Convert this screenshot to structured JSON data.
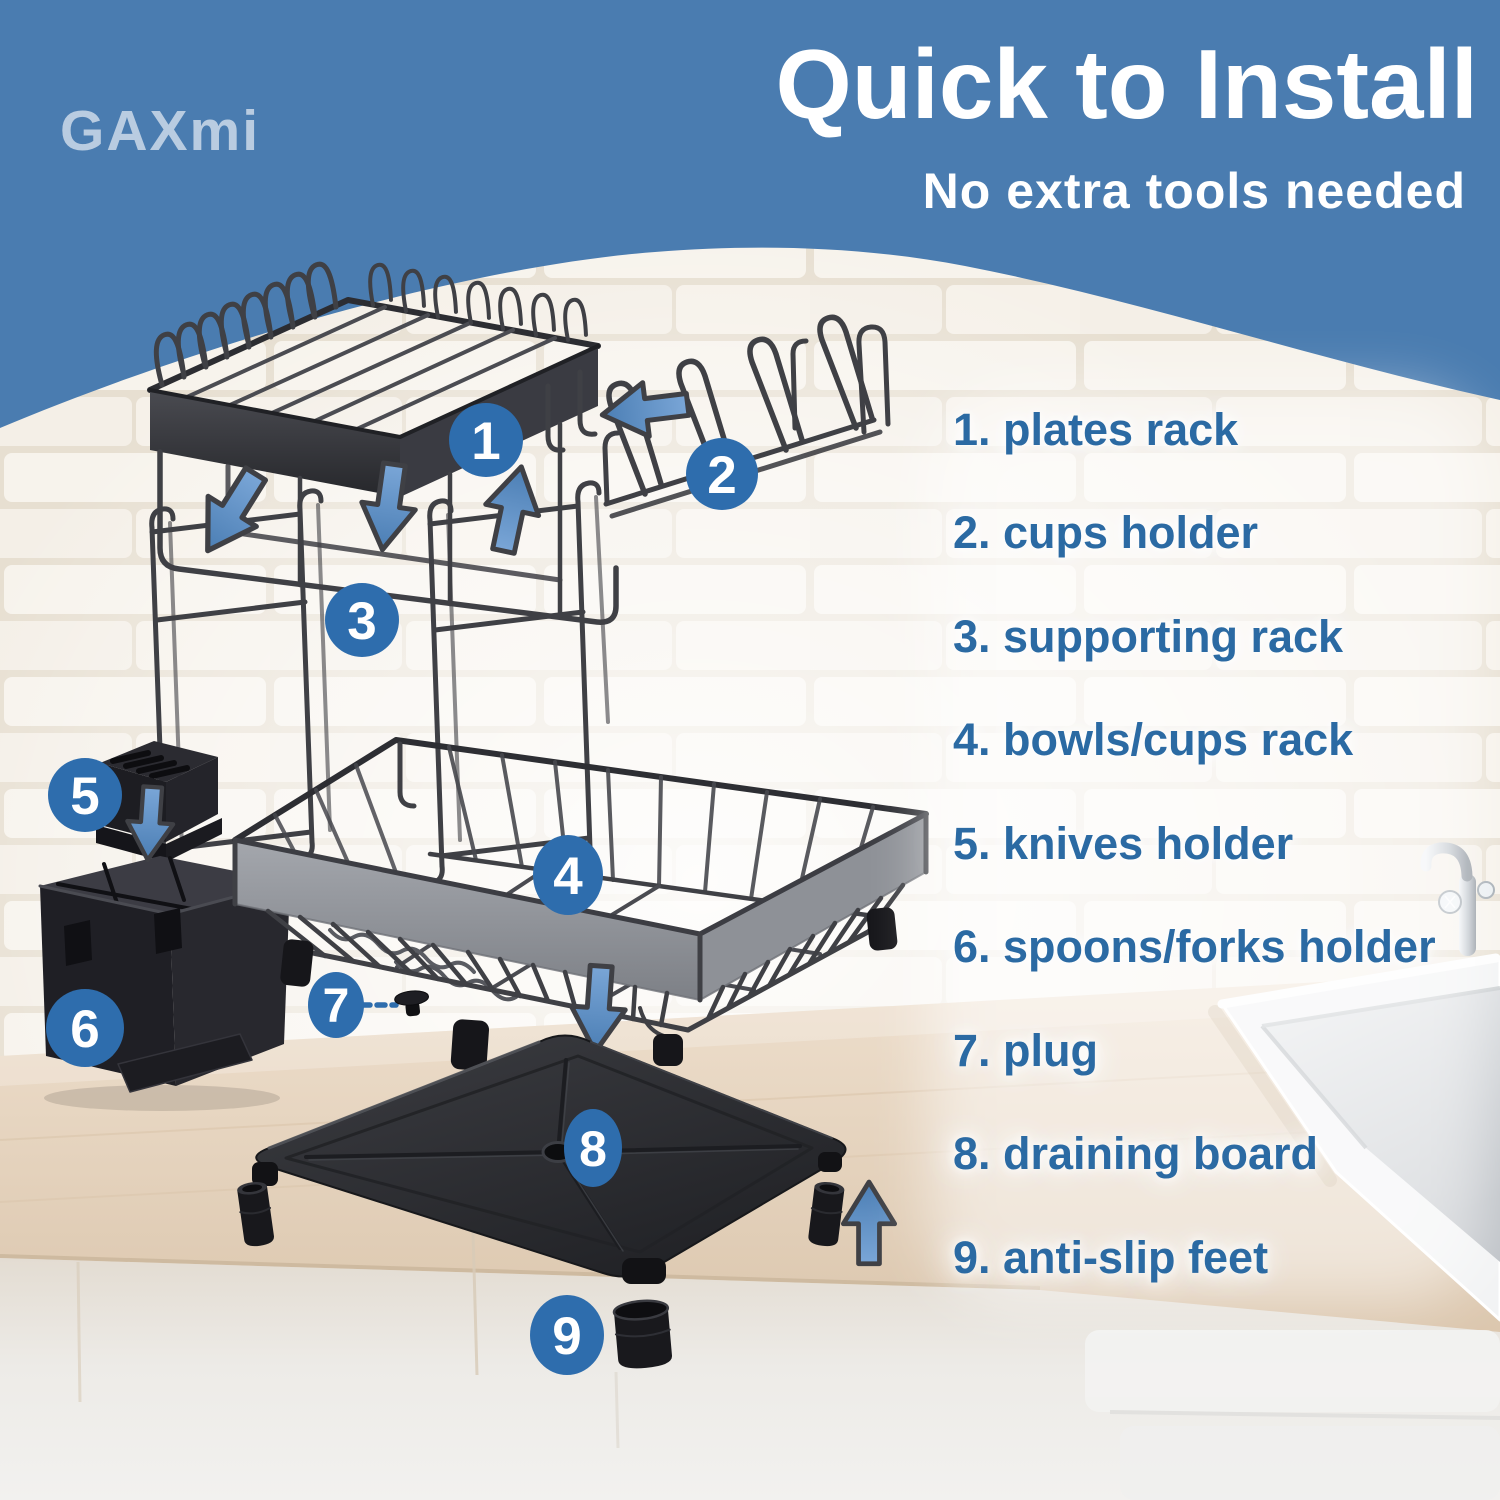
{
  "brand": "GAXmi",
  "header": {
    "title": "Quick to Install",
    "subtitle": "No extra tools needed"
  },
  "parts": [
    {
      "number": "1",
      "label": "plates rack",
      "list_text": "1. plates rack"
    },
    {
      "number": "2",
      "label": "cups holder",
      "list_text": "2. cups holder"
    },
    {
      "number": "3",
      "label": "supporting rack",
      "list_text": "3. supporting rack"
    },
    {
      "number": "4",
      "label": "bowls/cups rack",
      "list_text": "4. bowls/cups rack"
    },
    {
      "number": "5",
      "label": "knives holder",
      "list_text": "5. knives holder"
    },
    {
      "number": "6",
      "label": "spoons/forks holder",
      "list_text": "6. spoons/forks holder"
    },
    {
      "number": "7",
      "label": "plug",
      "list_text": "7. plug"
    },
    {
      "number": "8",
      "label": "draining board",
      "list_text": "8. draining board"
    },
    {
      "number": "9",
      "label": "anti-slip feet",
      "list_text": "9. anti-slip feet"
    }
  ],
  "colors": {
    "header_blue": "#4a7cb0",
    "badge_blue": "#2e6dad",
    "list_text_blue": "#2b6aa3",
    "arrow_blue": "#5d8fc6",
    "wire_metal": "#3f4045",
    "band_gray": "#8f9298",
    "plastic_black": "#1e1e23",
    "counter_beige": "#e4d3bd",
    "brick_white": "#f5f1e9"
  }
}
